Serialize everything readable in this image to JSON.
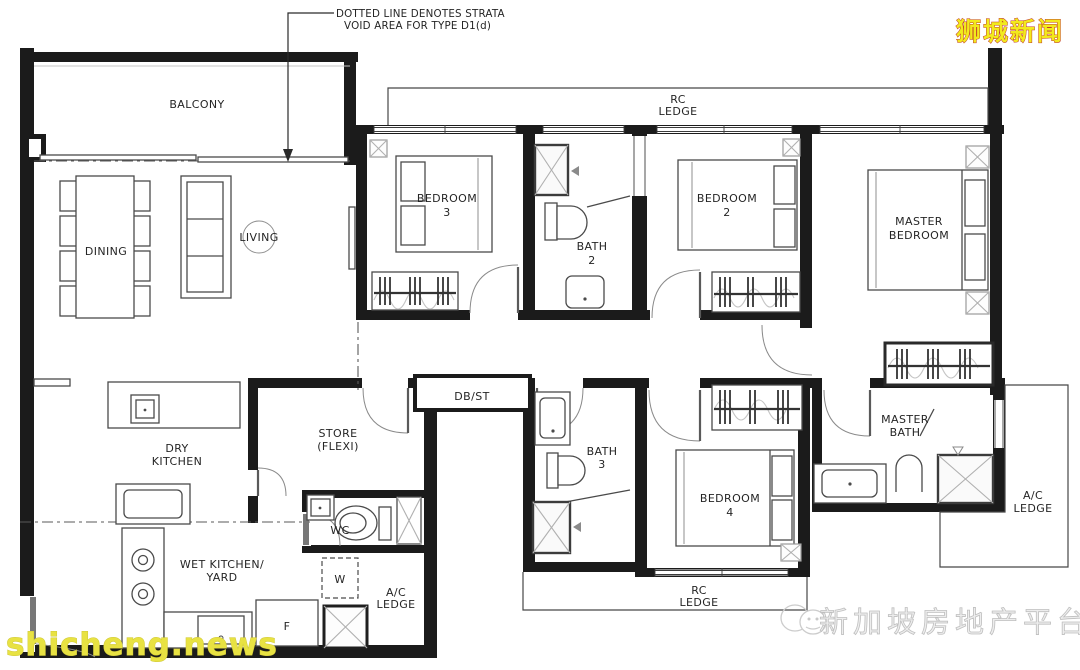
{
  "annotation": {
    "line1": "DOTTED LINE DENOTES STRATA",
    "line2": "VOID AREA FOR TYPE D1(d)"
  },
  "rooms": {
    "balcony": "BALCONY",
    "dining": "DINING",
    "living": "LIVING",
    "bedroom3": {
      "l1": "BEDROOM",
      "l2": "3"
    },
    "bath2": {
      "l1": "BATH",
      "l2": "2"
    },
    "bedroom2": {
      "l1": "BEDROOM",
      "l2": "2"
    },
    "master_bedroom": {
      "l1": "MASTER",
      "l2": "BEDROOM"
    },
    "rc_ledge_top": {
      "l1": "RC",
      "l2": "LEDGE"
    },
    "dbst": "DB/ST",
    "dry_kitchen": {
      "l1": "DRY",
      "l2": "KITCHEN"
    },
    "store": {
      "l1": "STORE",
      "l2": "(FLEXI)"
    },
    "bath3": {
      "l1": "BATH",
      "l2": "3"
    },
    "bedroom4": {
      "l1": "BEDROOM",
      "l2": "4"
    },
    "master_bath": {
      "l1": "MASTER",
      "l2": "BATH"
    },
    "wc": "WC",
    "wet_kitchen": {
      "l1": "WET KITCHEN/",
      "l2": "YARD"
    },
    "washer": "W",
    "fridge": "F",
    "ac_ledge_yard": {
      "l1": "A/C",
      "l2": "LEDGE"
    },
    "rc_ledge_bottom": {
      "l1": "RC",
      "l2": "LEDGE"
    },
    "ac_ledge_right": {
      "l1": "A/C",
      "l2": "LEDGE"
    }
  },
  "watermarks": {
    "brand": "狮城新闻",
    "site": "shicheng.news",
    "platform": "新加坡房地产平台",
    "brand_fill": "#f2ea1c",
    "brand_outline": "#c0392b",
    "site_fill": "#e8e242",
    "platform_fill": "#ededed"
  },
  "colors": {
    "wall": "#1b1b1b",
    "furniture_line": "#4a4a4a",
    "background": "#ffffff"
  }
}
